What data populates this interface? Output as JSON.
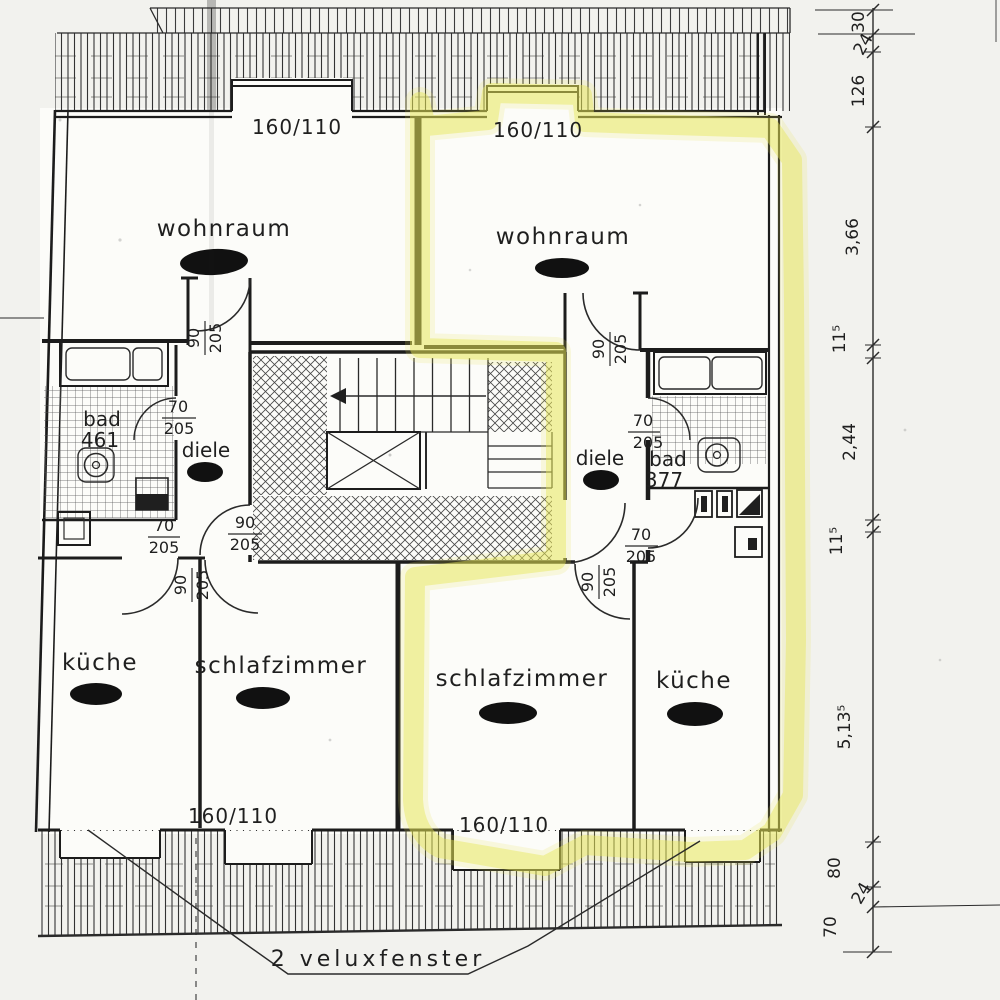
{
  "plan": {
    "type": "attic floor plan, two mirrored apartments, scanned drawing",
    "note_velux": "2  veluxfenster"
  },
  "colors": {
    "highlight": "#e7e656",
    "ink": "#1f1f1f",
    "paper": "#f2f2ee"
  },
  "rooms": {
    "left_wohnraum": "wohnraum",
    "right_wohnraum": "wohnraum",
    "left_bad_name": "bad",
    "left_bad_area": "461",
    "right_bad_name": "bad",
    "right_bad_area": "377",
    "left_diele": "diele",
    "right_diele": "diele",
    "left_kueche": "küche",
    "right_kueche": "küche",
    "left_schlafzimmer": "schlafzimmer",
    "right_schlafzimmer": "schlafzimmer"
  },
  "windows": {
    "top_left": "160/110",
    "top_right": "160/110",
    "bottom_left": "160/110",
    "bottom_right": "160/110"
  },
  "doors": {
    "left_bad": {
      "top": "70",
      "bottom": "205"
    },
    "left_entrance": {
      "top": "90",
      "bottom": "205"
    },
    "left_kueche": {
      "top": "70",
      "bottom": "205"
    },
    "left_wohnraum": {
      "top": "90",
      "bottom": "205"
    },
    "left_schlafzimmer": {
      "top": "90",
      "bottom": "205"
    },
    "right_bad": {
      "top": "70",
      "bottom": "205"
    },
    "right_kueche": {
      "top": "70",
      "bottom": "205"
    },
    "right_wohnraum": {
      "top": "90",
      "bottom": "205"
    },
    "right_schlafzimmer": {
      "top": "90",
      "bottom": "205"
    }
  },
  "dimensions": {
    "values": [
      "30",
      "24",
      "126",
      "3,66",
      "11⁵",
      "2,44",
      "11⁵",
      "5,13⁵",
      "80",
      "24",
      "70"
    ]
  }
}
